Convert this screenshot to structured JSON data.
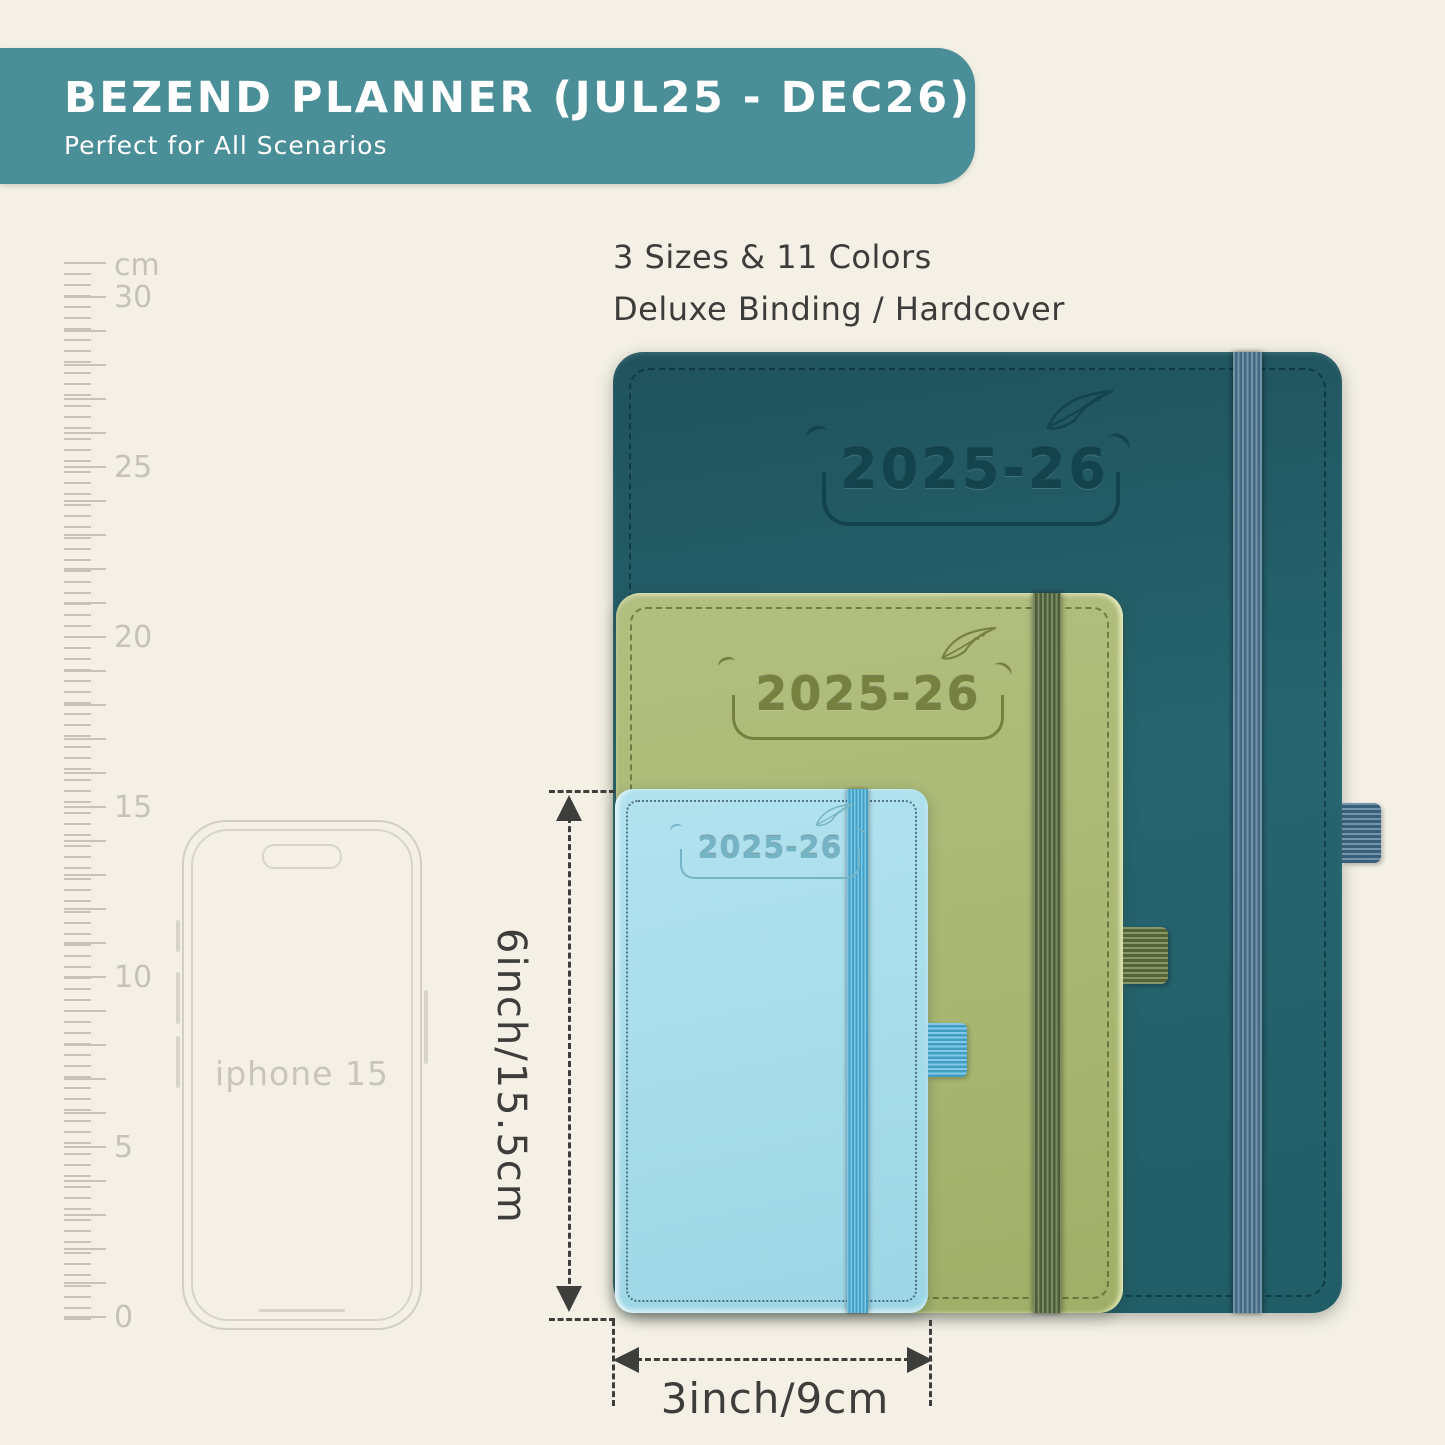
{
  "banner": {
    "title": "BEZEND PLANNER (JUL25 - DEC26)",
    "subtitle": "Perfect for All Scenarios",
    "bg_color": "#4a8e98",
    "text_color": "#ffffff"
  },
  "info": {
    "line1": "3 Sizes & 11 Colors",
    "line2": "Deluxe Binding / Hardcover"
  },
  "ruler": {
    "unit": "cm",
    "labels": [
      "30",
      "25",
      "20",
      "15",
      "10",
      "5",
      "0"
    ]
  },
  "planners": {
    "large": {
      "year": "2025-26",
      "cover_color": "#24606a",
      "band_color": "#4b7591",
      "icon": "feather-icon"
    },
    "medium": {
      "year": "2025-26",
      "cover_color": "#a9b873",
      "band_color": "#5d7144",
      "icon": "feather-icon"
    },
    "small": {
      "year": "2025-26",
      "cover_color": "#a6dcea",
      "band_color": "#48b2dc",
      "icon": "feather-icon"
    }
  },
  "phone": {
    "label": "iphone 15"
  },
  "dimensions": {
    "height_label": "6inch/15.5cm",
    "width_label": "3inch/9cm"
  },
  "background_color": "#f4f0e5"
}
